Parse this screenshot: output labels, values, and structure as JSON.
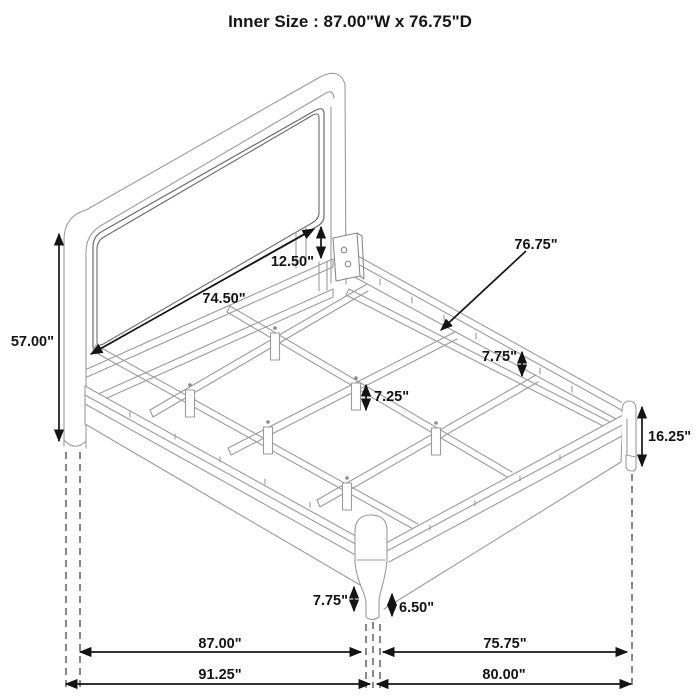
{
  "title": "Inner Size : 87.00\"W x 76.75\"D",
  "diagram": {
    "subject": "bed-frame-dimension-diagram",
    "view": "isometric line drawing",
    "units": "inches",
    "art_color": "#9b9b9b",
    "dim_color": "#141414"
  },
  "dims": {
    "headboard_inner_width": "74.50\"",
    "panel_to_rail": "12.50\"",
    "headboard_height": "57.00\"",
    "inner_depth": "76.75\"",
    "rail_to_stringer": "7.75\"",
    "center_leg_height": "7.25\"",
    "foot_corner_height": "16.25\"",
    "front_leg_height": "7.75\"",
    "front_leg_taper": "6.50\"",
    "inner_width": "87.00\"",
    "foot_inner_depth": "75.75\"",
    "overall_width": "91.25\"",
    "overall_depth": "80.00\""
  }
}
